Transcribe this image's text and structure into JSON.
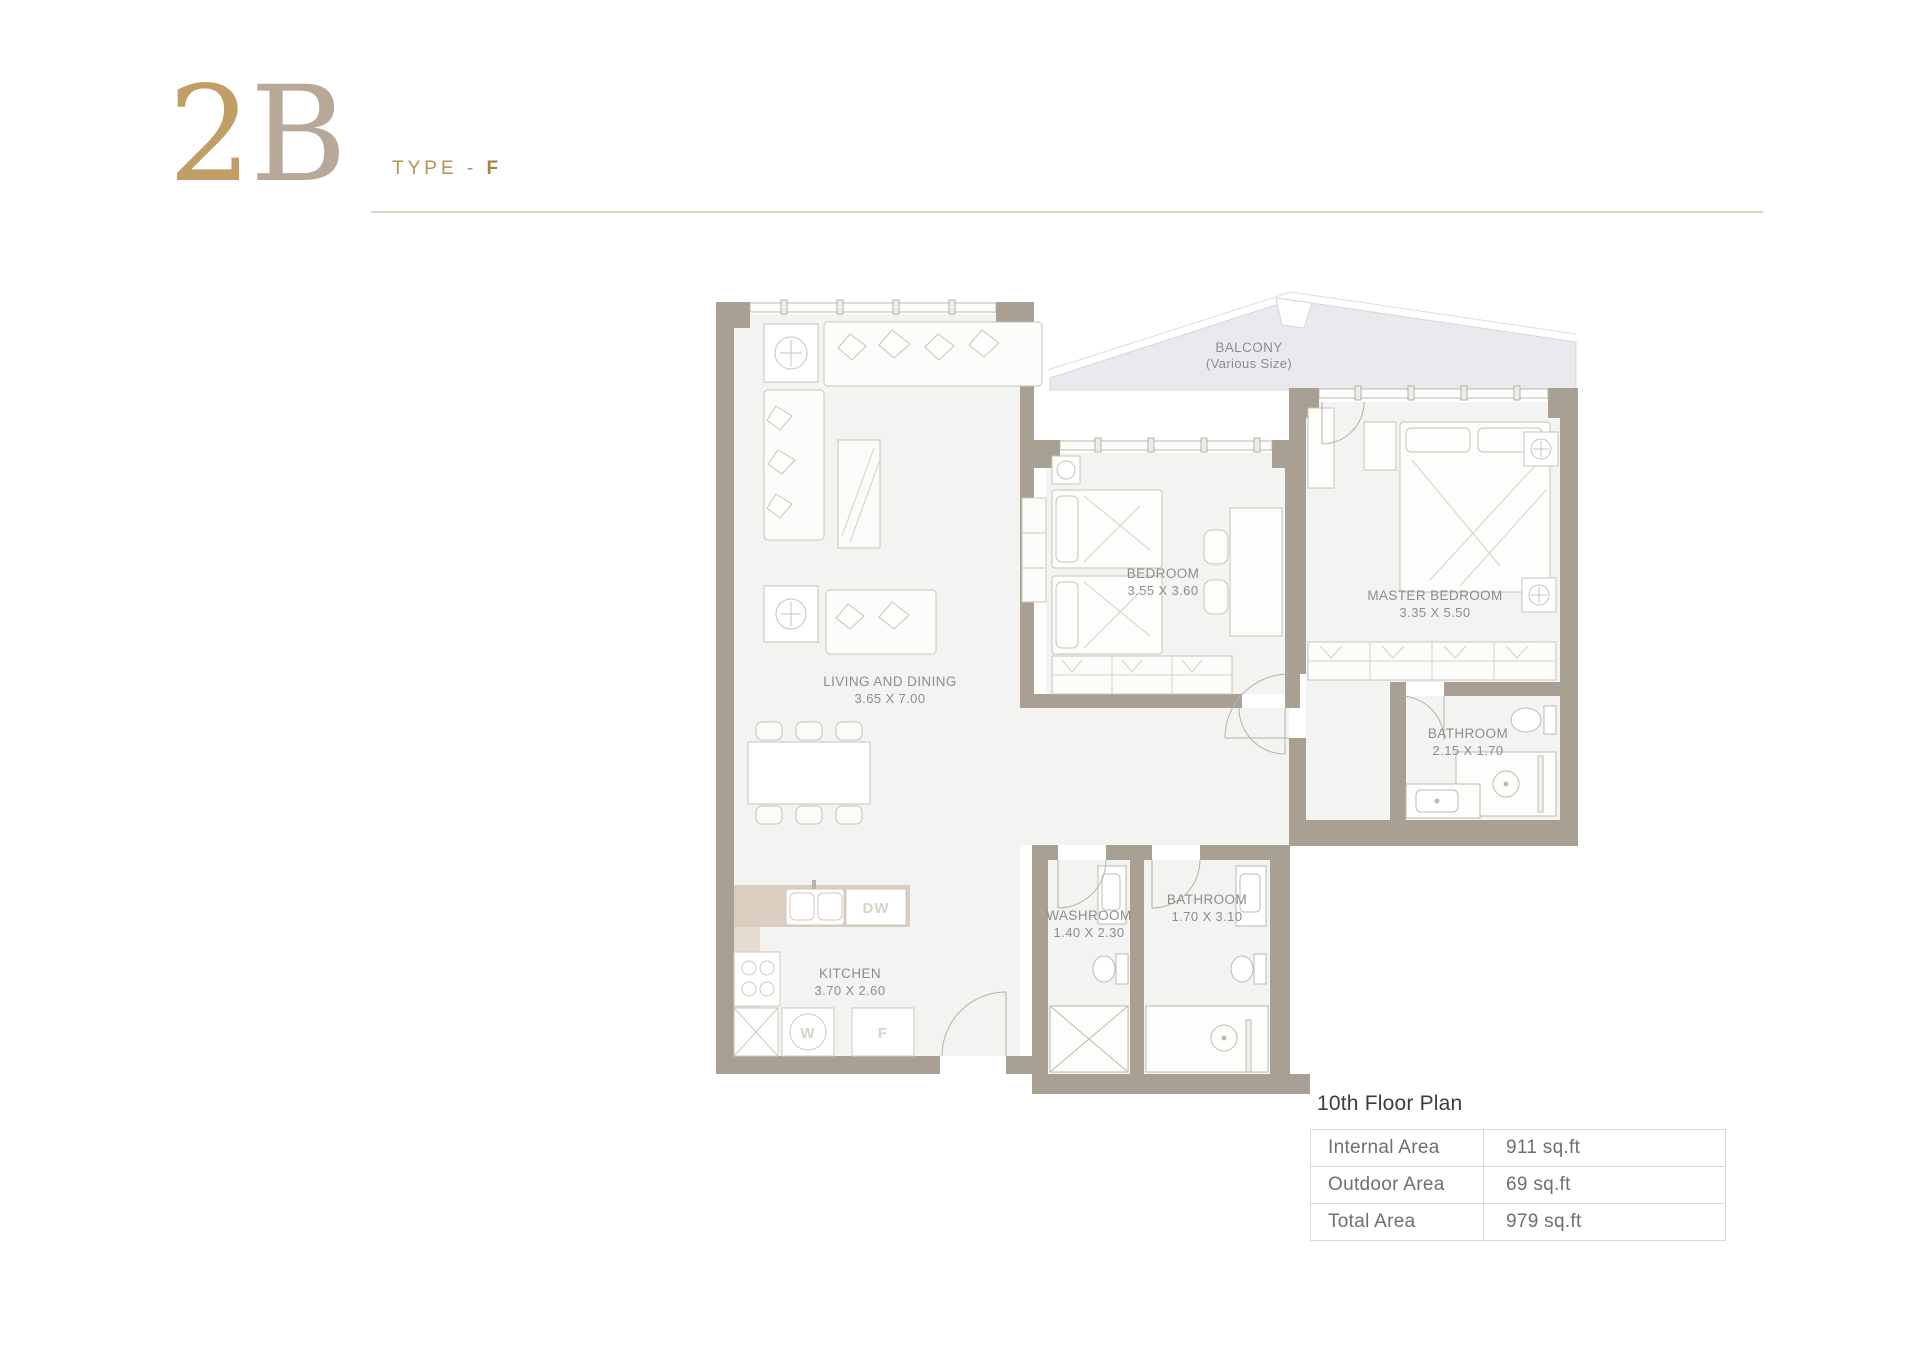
{
  "header": {
    "title_first": "2",
    "title_second": "B",
    "type_label": "TYPE -",
    "type_value": "F"
  },
  "plan": {
    "balcony": {
      "name": "BALCONY",
      "note": "(Various Size)"
    },
    "rooms": [
      {
        "name": "LIVING AND DINING",
        "dims": "3.65 X 7.00"
      },
      {
        "name": "BEDROOM",
        "dims": "3.55 X 3.60"
      },
      {
        "name": "MASTER BEDROOM",
        "dims": "3.35 X 5.50"
      },
      {
        "name": "BATHROOM",
        "dims": "2.15 X 1.70"
      },
      {
        "name": "WASHROOM",
        "dims": "1.40 X 2.30"
      },
      {
        "name": "BATHROOM",
        "dims": "1.70 X 3.10"
      },
      {
        "name": "KITCHEN",
        "dims": "3.70 X 2.60"
      }
    ],
    "appliances": {
      "dishwasher": "DW",
      "washer": "W",
      "fridge": "F"
    }
  },
  "area_table": {
    "title": "10th Floor Plan",
    "rows": [
      {
        "label": "Internal Area",
        "value": "911 sq.ft"
      },
      {
        "label": "Outdoor Area",
        "value": "69 sq.ft"
      },
      {
        "label": "Total Area",
        "value": "979 sq.ft"
      }
    ]
  },
  "colors": {
    "accent_gold": "#b49357",
    "title_gold": "#c19e66",
    "title_taupe": "#b7a897",
    "wall": "#a9a094",
    "room_fill": "#f3f3f1",
    "balcony_fill": "#e8eaee",
    "counter_tan": "#dbcdc0",
    "label_gray": "#8d8d8b",
    "rule_khaki": "#dbd6c0"
  }
}
